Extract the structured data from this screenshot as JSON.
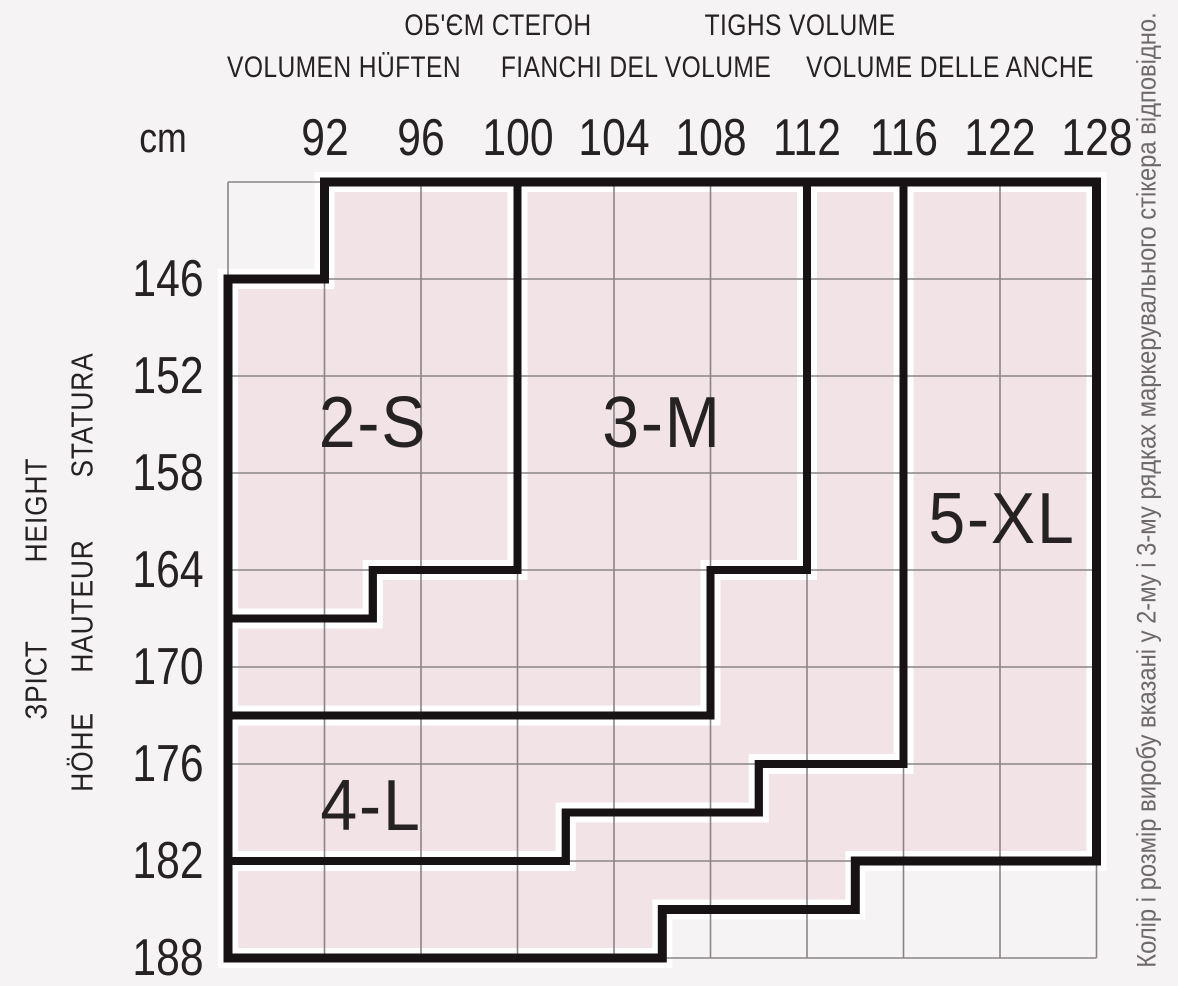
{
  "header": {
    "row1": [
      {
        "text": "ОБ'ЄМ СТЕГОН",
        "x": 498,
        "y": 26
      },
      {
        "text": "TIGHS VOLUME",
        "x": 800,
        "y": 26
      }
    ],
    "row2": [
      {
        "text": "VOLUMEN HÜFTEN",
        "x": 344,
        "y": 68
      },
      {
        "text": "FIANCHI DEL VOLUME",
        "x": 636,
        "y": 68
      },
      {
        "text": "VOLUME DELLE ANCHE",
        "x": 950,
        "y": 68
      }
    ],
    "unit": {
      "text": "cm",
      "x": 163,
      "y": 138
    }
  },
  "left_axis_words": [
    {
      "text": "STATURA",
      "x": 82,
      "y": 415
    },
    {
      "text": "HAUTEUR",
      "x": 82,
      "y": 606
    },
    {
      "text": "HÖHE",
      "x": 82,
      "y": 752
    },
    {
      "text": "HEIGHT",
      "x": 36,
      "y": 510
    },
    {
      "text": "ЗРІСТ",
      "x": 36,
      "y": 680
    }
  ],
  "right_note": {
    "text": "Колір і розмір виробу вказані у 2-му і 3-му рядках маркерувального стікера відповідно.",
    "x": 1147,
    "y": 490
  },
  "chart_data": {
    "type": "size-region-grid",
    "title": "Tights size chart: hip volume (cm) vs height (cm)",
    "x_axis": {
      "label": "hip volume, cm",
      "tick_y": 138,
      "ticks": [
        "92",
        "96",
        "100",
        "104",
        "108",
        "112",
        "116",
        "122",
        "128"
      ]
    },
    "y_axis": {
      "label": "height, cm",
      "tick_x": 168,
      "ticks": [
        "146",
        "152",
        "158",
        "164",
        "170",
        "176",
        "182",
        "188"
      ]
    },
    "grid": {
      "x0": 228,
      "y0": 182,
      "col_width": 96.5,
      "row_height": 97,
      "n_cols": 9,
      "n_rows": 8
    },
    "colors": {
      "background": "#f6f3f4",
      "region_fill": "#f2e3e6",
      "grid_line": "#8a8487",
      "border": "#171314",
      "gutter": "#ffffff",
      "text_dark": "#262223",
      "text_note": "#6e696b"
    },
    "regions": [
      {
        "id": "2-S",
        "label": "2-S",
        "label_x": 373,
        "label_y": 423,
        "points": [
          [
            1,
            0
          ],
          [
            3,
            0
          ],
          [
            3,
            4
          ],
          [
            1.5,
            4
          ],
          [
            1.5,
            4.5
          ],
          [
            0,
            4.5
          ],
          [
            0,
            1
          ],
          [
            1,
            1
          ]
        ]
      },
      {
        "id": "3-M",
        "label": "3-M",
        "label_x": 662,
        "label_y": 423,
        "points": [
          [
            3,
            0
          ],
          [
            6,
            0
          ],
          [
            6,
            4
          ],
          [
            5,
            4
          ],
          [
            5,
            5.5
          ],
          [
            0,
            5.5
          ],
          [
            0,
            4.5
          ],
          [
            1.5,
            4.5
          ],
          [
            1.5,
            4
          ],
          [
            3,
            4
          ]
        ]
      },
      {
        "id": "4-L",
        "label": "4-L",
        "label_x": 371,
        "label_y": 806,
        "points": [
          [
            6,
            0
          ],
          [
            7,
            0
          ],
          [
            7,
            6
          ],
          [
            5.5,
            6
          ],
          [
            5.5,
            6.5
          ],
          [
            3.5,
            6.5
          ],
          [
            3.5,
            7
          ],
          [
            0,
            7
          ],
          [
            0,
            5.5
          ],
          [
            5,
            5.5
          ],
          [
            5,
            4
          ],
          [
            6,
            4
          ]
        ]
      },
      {
        "id": "5-XL",
        "label": "5-XL",
        "label_x": 1002,
        "label_y": 519,
        "points": [
          [
            7,
            0
          ],
          [
            9,
            0
          ],
          [
            9,
            7
          ],
          [
            6.5,
            7
          ],
          [
            6.5,
            7.5
          ],
          [
            4.5,
            7.5
          ],
          [
            4.5,
            8
          ],
          [
            0,
            8
          ],
          [
            0,
            7
          ],
          [
            3.5,
            7
          ],
          [
            3.5,
            6.5
          ],
          [
            5.5,
            6.5
          ],
          [
            5.5,
            6
          ],
          [
            7,
            6
          ]
        ]
      }
    ],
    "outer_boundary": [
      [
        1,
        0
      ],
      [
        9,
        0
      ],
      [
        9,
        7
      ],
      [
        6.5,
        7
      ],
      [
        6.5,
        7.5
      ],
      [
        4.5,
        7.5
      ],
      [
        4.5,
        8
      ],
      [
        0,
        8
      ],
      [
        0,
        1
      ],
      [
        1,
        1
      ]
    ]
  }
}
